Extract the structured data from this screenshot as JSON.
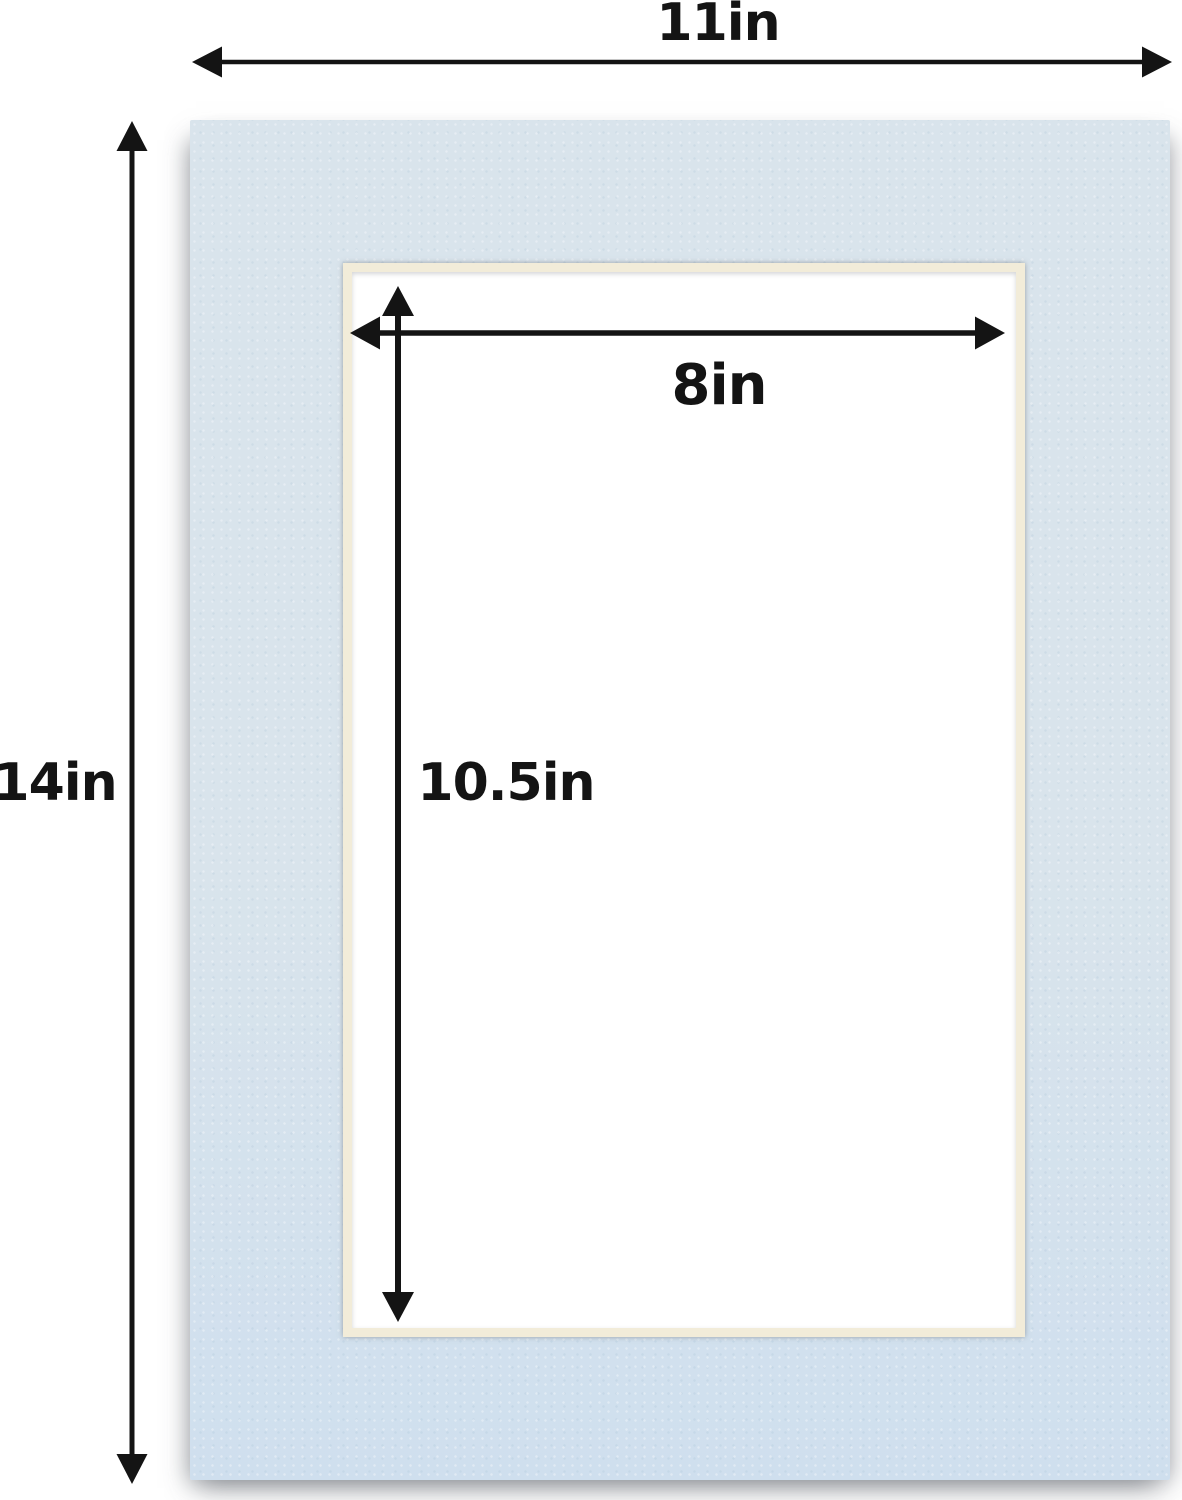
{
  "diagram": {
    "description": "Dimension diagram of a light blue picture-frame mat board with an off-white bevel-cut rectangular opening",
    "outer_size": "11in x 14in",
    "opening_size": "8in x 10.5in"
  },
  "labels": {
    "outer_width": "11in",
    "outer_height": "14in",
    "opening_width": "8in",
    "opening_height": "10.5in"
  },
  "values_inches": {
    "outer_width": 11,
    "outer_height": 14,
    "opening_width": 8,
    "opening_height": 10.5
  },
  "colors": {
    "mat": "#d9e4ec",
    "mat-deep": "#cfdfee",
    "bevel": "#f2ecd9",
    "arrow": "#141414",
    "text": "#141414",
    "background": "#ffffff"
  }
}
